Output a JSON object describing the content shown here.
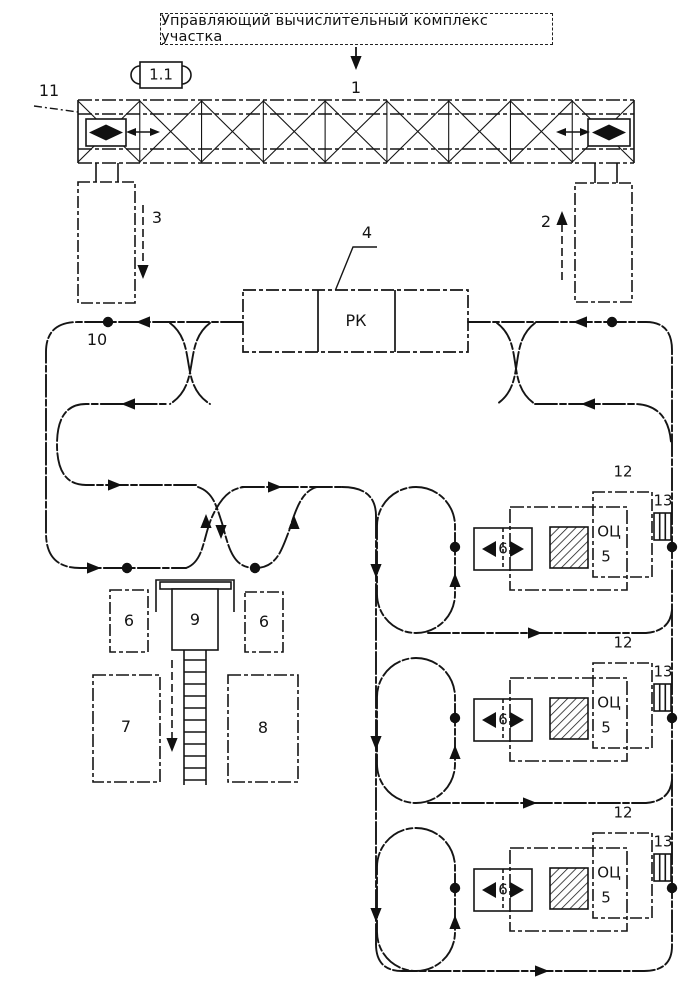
{
  "title": "Управляющий вычислительный комплекс участка",
  "labels": {
    "computer_link": "1",
    "terminal_box": "1.1",
    "crane_trolley": "11",
    "stacker_right": "2",
    "stacker_left": "3",
    "rk_callout": "4",
    "rk_station": "РК",
    "loop_point": "10",
    "table_left": "6",
    "robot": "9",
    "table_right": "6",
    "store_left": "7",
    "store_right": "8"
  },
  "modules": [
    {
      "shuttle": "6",
      "mc": "ОЦ",
      "mc_num": "5",
      "pallet": "12",
      "magazine": "13"
    },
    {
      "shuttle": "6",
      "mc": "ОЦ",
      "mc_num": "5",
      "pallet": "12",
      "magazine": "13"
    },
    {
      "shuttle": "6",
      "mc": "ОЦ",
      "mc_num": "5",
      "pallet": "12",
      "magazine": "13"
    }
  ]
}
